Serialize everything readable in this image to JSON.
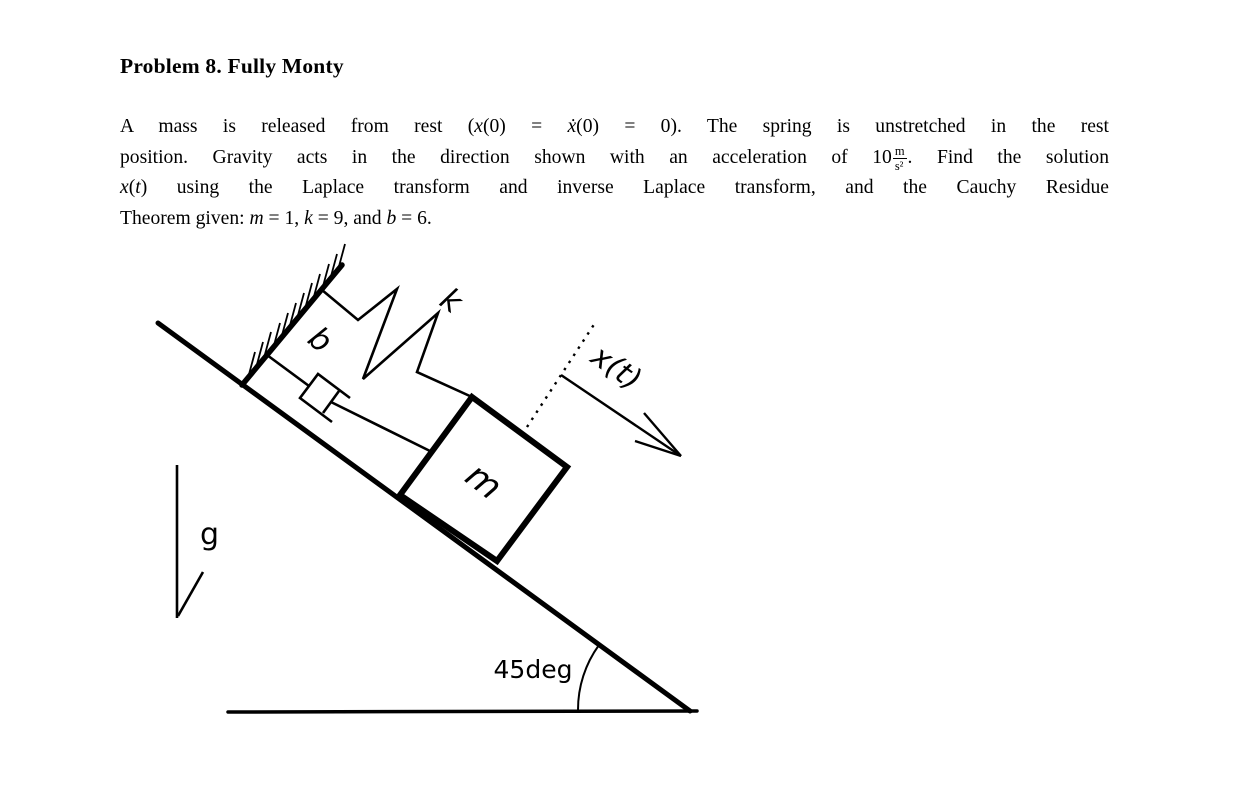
{
  "title": "Problem 8. Fully Monty",
  "problem": {
    "line1": {
      "seg1": "A mass is released from rest (",
      "seg2": "x",
      "seg3": "(0) = ",
      "seg4": "ẋ",
      "seg5": "(0) = 0).  The spring is unstretched in the rest"
    },
    "line2": {
      "seg1": "position.  Gravity acts in the direction shown with an acceleration of 10",
      "frac_num": "m",
      "frac_den": "s²",
      "seg2": ".  Find the solution"
    },
    "line3": {
      "seg1": "x",
      "seg2": "(",
      "seg3": "t",
      "seg4": ") using the Laplace transform and inverse Laplace transform, and the Cauchy Residue"
    },
    "line4": {
      "seg1": "Theorem given: ",
      "seg2": "m",
      "seg3": " = 1, ",
      "seg4": "k",
      "seg5": " = 9, and ",
      "seg6": "b",
      "seg7": " = 6."
    }
  },
  "diagram": {
    "labels": {
      "damper": "b",
      "spring": "k",
      "mass": "m",
      "displacement": "x(t)",
      "gravity": "g",
      "angle": "45deg"
    },
    "angle_value": "45deg",
    "stroke_color": "#000000"
  }
}
